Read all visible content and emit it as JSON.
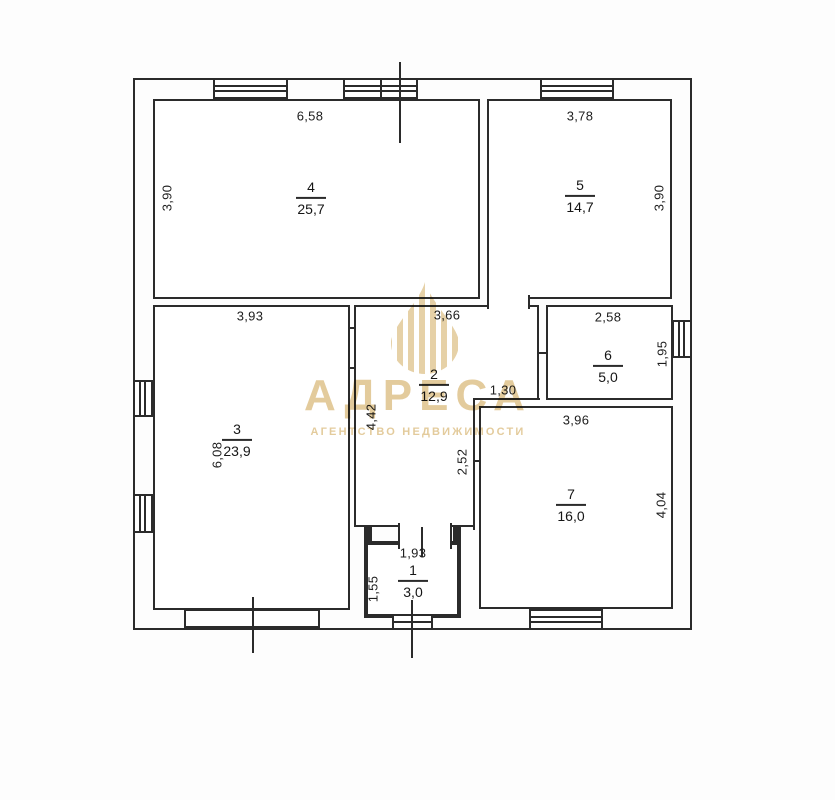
{
  "plan": {
    "rooms": [
      {
        "number": "1",
        "area": "3,0",
        "top_dim": "1,93",
        "side_dim": "1,55"
      },
      {
        "number": "2",
        "area": "12,9",
        "top_dim": "3,66",
        "side_dim": "4,42"
      },
      {
        "number": "3",
        "area": "23,9",
        "top_dim": "3,93",
        "side_dim": "6,08"
      },
      {
        "number": "4",
        "area": "25,7",
        "top_dim": "6,58",
        "side_dim": "3,90"
      },
      {
        "number": "5",
        "area": "14,7",
        "top_dim": "3,78",
        "side_dim": "3,90"
      },
      {
        "number": "6",
        "area": "5,0",
        "top_dim": "2,58",
        "side_dim": "1,95"
      },
      {
        "number": "7",
        "area": "16,0",
        "top_dim": "3,96",
        "side_dim": "4,04"
      }
    ],
    "extra_dims": {
      "notch_width": "1,30",
      "notch_height": "2,52"
    }
  },
  "watermark": {
    "title": "АДРЕСА",
    "subtitle": "АГЕНТСТВО НЕДВИЖИМОСТИ",
    "color": "#d2ab60"
  },
  "colors": {
    "line": "#2b2b2b",
    "background": "#ffffff"
  }
}
